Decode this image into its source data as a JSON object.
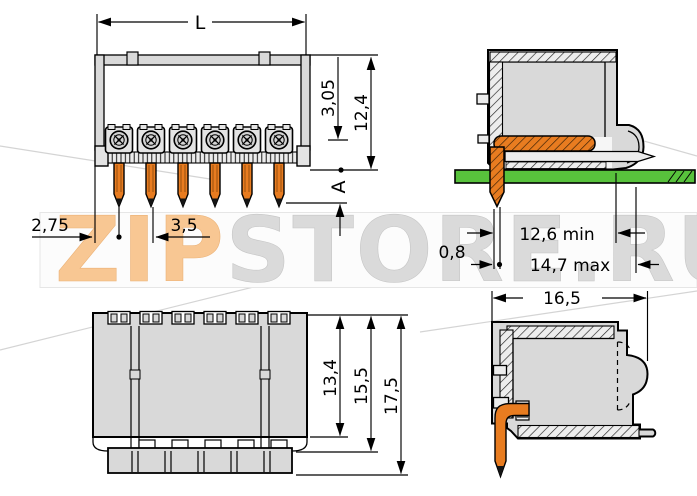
{
  "watermark": {
    "prefix": "ZIP",
    "suffix": "STORE.RU"
  },
  "colors": {
    "pin_orange": "#e87c20",
    "pcb_green": "#58c23c",
    "housing_gray": "#d9d9d9",
    "hatch_bg": "#ededed",
    "contact_gray": "#d2d2d2",
    "watermark_orange": "#f8c793",
    "watermark_gray": "#dadada",
    "band_bg": "#fcfcfc",
    "band_border": "#e6e6e6"
  },
  "front_view": {
    "dim_overall_width": "L",
    "dim_3_05": "3,05",
    "dim_12_4": "12,4",
    "dim_2_75": "2,75",
    "dim_3_5": "3,5",
    "dim_a": "A"
  },
  "pcb_view": {
    "dim_0_8": "0,8",
    "dim_12_6": "12,6 min",
    "dim_14_7": "14,7 max"
  },
  "top_view": {
    "dim_13_4": "13,4",
    "dim_15_5": "15,5",
    "dim_17_5": "17,5"
  },
  "side_view": {
    "dim_16_5": "16,5"
  }
}
